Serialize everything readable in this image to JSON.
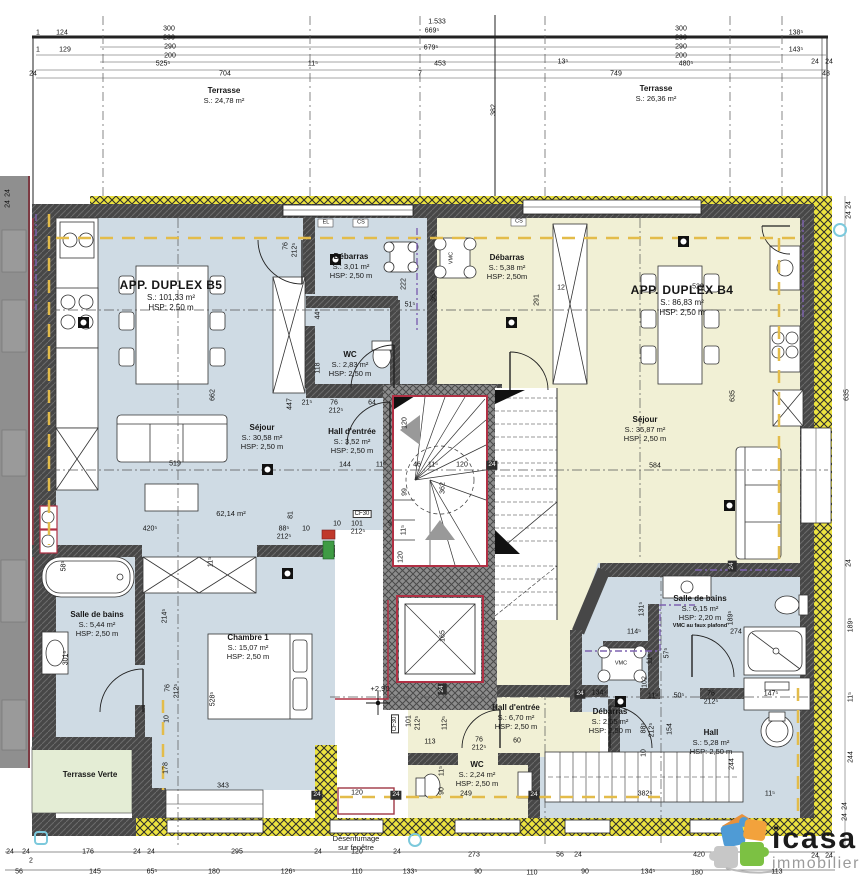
{
  "document": {
    "type": "Plan d'étage duplex",
    "level_marker": "+2,90"
  },
  "logo": {
    "brand": "icasa",
    "tagline": "immobilier"
  },
  "terraces": {
    "left": {
      "name": "Terrasse",
      "area": "S.: 24,78 m²"
    },
    "right": {
      "name": "Terrasse",
      "area": "S.: 26,36 m²"
    },
    "verte": {
      "name": "Terrasse Verte"
    }
  },
  "apartment_b5": {
    "title": "APP. DUPLEX B5",
    "area": "S.: 101,33 m²",
    "height": "HSP: 2,50 m",
    "rooms": {
      "debarras": {
        "name": "Débarras",
        "area": "S.: 3,01 m²",
        "height": "HSP: 2,50 m"
      },
      "wc": {
        "name": "WC",
        "area": "S.: 2,83 m²",
        "height": "HSP: 2,50 m"
      },
      "hall": {
        "name": "Hall d'entrée",
        "area": "S.: 3,52 m²",
        "height": "HSP: 2,50 m"
      },
      "sejour": {
        "name": "Séjour",
        "area": "S.: 30,58 m²",
        "height": "HSP: 2,50 m",
        "zone_area": "62,14 m²"
      },
      "salle_de_bains": {
        "name": "Salle de bains",
        "area": "S.: 5,44 m²",
        "height": "HSP: 2,50 m"
      },
      "chambre": {
        "name": "Chambre 1",
        "area": "S.: 15,07 m²",
        "height": "HSP: 2,50 m"
      }
    }
  },
  "apartment_b4": {
    "title": "APP. DUPLEX B4",
    "area": "S.: 86,83 m²",
    "height": "HSP: 2,50 m",
    "rooms": {
      "debarras": {
        "name": "Débarras",
        "area": "S.: 5,38 m²",
        "height": "HSP: 2,50m"
      },
      "sejour": {
        "name": "Séjour",
        "area": "S.: 35,87 m²",
        "height": "HSP: 2,50 m"
      },
      "hall_entree": {
        "name": "Hall d'entrée",
        "area": "S.: 6,70 m²",
        "height": "HSP: 2,50 m"
      },
      "wc": {
        "name": "WC",
        "area": "S.: 2,24 m²",
        "height": "HSP: 2,50 m"
      },
      "salle_de_bains": {
        "name": "Salle de bains",
        "area": "S.: 6,15 m²",
        "height": "HSP: 2,20 m",
        "note": "VMC au faux plafond"
      },
      "debarras2": {
        "name": "Débarras",
        "area": "S.: 2,65 m²",
        "height": "HSP: 2,50 m"
      },
      "hall": {
        "name": "Hall",
        "area": "S.: 5,28 m²",
        "height": "HSP: 2,50 m"
      }
    }
  },
  "annotations": {
    "desenfumage_1": "Désenfumage",
    "desenfumage_2": "sur fenêtre",
    "colors": {
      "b5_fill": "#cfdbe4",
      "b4_fill": "#f1f0d5",
      "green_fill": "#e4edd5",
      "wall": "#474747",
      "insulation": "#ece33f",
      "fire_wall": "#b03044",
      "gas_line": "#e3bc4a",
      "vmc_line": "#7e63b0",
      "marker_cyan": "#7cc9dc"
    },
    "dimensions": [
      {
        "t": "124",
        "x": 62,
        "y": 33
      },
      {
        "t": "1",
        "x": 38,
        "y": 33
      },
      {
        "t": "300",
        "x": 169,
        "y": 29
      },
      {
        "t": "230",
        "x": 169,
        "y": 38
      },
      {
        "t": "1",
        "x": 38,
        "y": 50
      },
      {
        "t": "129",
        "x": 65,
        "y": 50
      },
      {
        "t": "290",
        "x": 170,
        "y": 47
      },
      {
        "t": "200",
        "x": 170,
        "y": 56
      },
      {
        "t": "525⁵",
        "x": 163,
        "y": 64
      },
      {
        "t": "11⁵",
        "x": 313,
        "y": 64
      },
      {
        "t": "24",
        "x": 33,
        "y": 74
      },
      {
        "t": "704",
        "x": 225,
        "y": 74
      },
      {
        "t": "1.533",
        "x": 437,
        "y": 22
      },
      {
        "t": "669⁵",
        "x": 432,
        "y": 31
      },
      {
        "t": "679⁵",
        "x": 431,
        "y": 48
      },
      {
        "t": "453",
        "x": 440,
        "y": 64
      },
      {
        "t": "7",
        "x": 420,
        "y": 74
      },
      {
        "t": "382",
        "x": 494,
        "y": 110,
        "v": 1
      },
      {
        "t": "300",
        "x": 681,
        "y": 29
      },
      {
        "t": "230",
        "x": 681,
        "y": 38
      },
      {
        "t": "290",
        "x": 681,
        "y": 47
      },
      {
        "t": "200",
        "x": 681,
        "y": 56
      },
      {
        "t": "13⁵",
        "x": 563,
        "y": 62
      },
      {
        "t": "480⁵",
        "x": 686,
        "y": 64
      },
      {
        "t": "138⁵",
        "x": 796,
        "y": 33
      },
      {
        "t": "143⁵",
        "x": 796,
        "y": 50
      },
      {
        "t": "24",
        "x": 815,
        "y": 62
      },
      {
        "t": "24",
        "x": 829,
        "y": 62
      },
      {
        "t": "749",
        "x": 616,
        "y": 74
      },
      {
        "t": "48",
        "x": 826,
        "y": 74
      },
      {
        "t": "24",
        "x": 8,
        "y": 193,
        "v": 1
      },
      {
        "t": "24",
        "x": 8,
        "y": 204,
        "v": 1
      },
      {
        "t": "24",
        "x": 849,
        "y": 205,
        "v": 1
      },
      {
        "t": "24",
        "x": 849,
        "y": 215,
        "v": 1
      },
      {
        "t": "635",
        "x": 847,
        "y": 395,
        "v": 1
      },
      {
        "t": "24",
        "x": 849,
        "y": 563,
        "v": 1
      },
      {
        "t": "189⁵",
        "x": 851,
        "y": 625,
        "v": 1
      },
      {
        "t": "11⁵",
        "x": 851,
        "y": 697,
        "v": 1
      },
      {
        "t": "244",
        "x": 851,
        "y": 757,
        "v": 1
      },
      {
        "t": "24",
        "x": 845,
        "y": 806,
        "v": 1
      },
      {
        "t": "24",
        "x": 845,
        "y": 817,
        "v": 1
      },
      {
        "t": "76",
        "x": 286,
        "y": 246,
        "v": 1
      },
      {
        "t": "212⁵",
        "x": 295,
        "y": 250,
        "v": 1
      },
      {
        "t": "222",
        "x": 404,
        "y": 284,
        "v": 1
      },
      {
        "t": "51⁵",
        "x": 410,
        "y": 305
      },
      {
        "t": "44⁵",
        "x": 318,
        "y": 314,
        "v": 1
      },
      {
        "t": "118",
        "x": 318,
        "y": 368,
        "v": 1
      },
      {
        "t": "662",
        "x": 213,
        "y": 395,
        "v": 1
      },
      {
        "t": "447",
        "x": 290,
        "y": 404,
        "v": 1
      },
      {
        "t": "21⁵",
        "x": 307,
        "y": 403
      },
      {
        "t": "76",
        "x": 334,
        "y": 403
      },
      {
        "t": "212⁵",
        "x": 336,
        "y": 411
      },
      {
        "t": "64",
        "x": 372,
        "y": 403
      },
      {
        "t": "519",
        "x": 175,
        "y": 464
      },
      {
        "t": "420⁵",
        "x": 150,
        "y": 529
      },
      {
        "t": "88⁵",
        "x": 284,
        "y": 529
      },
      {
        "t": "212⁵",
        "x": 284,
        "y": 537
      },
      {
        "t": "10",
        "x": 306,
        "y": 529
      },
      {
        "t": "81",
        "x": 291,
        "y": 515,
        "v": 1
      },
      {
        "t": "58⁵",
        "x": 64,
        "y": 566,
        "v": 1
      },
      {
        "t": "11⁵",
        "x": 211,
        "y": 562,
        "v": 1
      },
      {
        "t": "214⁵",
        "x": 165,
        "y": 616,
        "v": 1
      },
      {
        "t": "301⁵",
        "x": 66,
        "y": 658,
        "v": 1
      },
      {
        "t": "528⁵",
        "x": 213,
        "y": 699,
        "v": 1
      },
      {
        "t": "76",
        "x": 168,
        "y": 688,
        "v": 1
      },
      {
        "t": "212⁵",
        "x": 177,
        "y": 691,
        "v": 1
      },
      {
        "t": "10",
        "x": 167,
        "y": 719,
        "v": 1
      },
      {
        "t": "178",
        "x": 166,
        "y": 768,
        "v": 1
      },
      {
        "t": "343",
        "x": 223,
        "y": 786
      },
      {
        "t": "24",
        "x": 317,
        "y": 795,
        "inv": 1
      },
      {
        "t": "120",
        "x": 357,
        "y": 793
      },
      {
        "t": "24",
        "x": 396,
        "y": 795,
        "inv": 1
      },
      {
        "t": "120",
        "x": 405,
        "y": 423,
        "v": 1
      },
      {
        "t": "144",
        "x": 345,
        "y": 465
      },
      {
        "t": "11⁵",
        "x": 381,
        "y": 465
      },
      {
        "t": "46",
        "x": 417,
        "y": 465
      },
      {
        "t": "11⁵",
        "x": 433,
        "y": 465
      },
      {
        "t": "120",
        "x": 462,
        "y": 465
      },
      {
        "t": "24",
        "x": 492,
        "y": 465,
        "inv": 1
      },
      {
        "t": "99",
        "x": 405,
        "y": 492,
        "v": 1
      },
      {
        "t": "362",
        "x": 443,
        "y": 488,
        "v": 1
      },
      {
        "t": "CF30",
        "x": 362,
        "y": 514,
        "box": 1
      },
      {
        "t": "10",
        "x": 337,
        "y": 524
      },
      {
        "t": "101",
        "x": 357,
        "y": 524
      },
      {
        "t": "212⁵",
        "x": 358,
        "y": 532
      },
      {
        "t": "9",
        "x": 390,
        "y": 524
      },
      {
        "t": "11⁵",
        "x": 404,
        "y": 530,
        "v": 1
      },
      {
        "t": "120",
        "x": 401,
        "y": 557,
        "v": 1
      },
      {
        "t": "165",
        "x": 443,
        "y": 636,
        "v": 1
      },
      {
        "t": "24",
        "x": 442,
        "y": 689,
        "v": 1,
        "inv": 1
      },
      {
        "t": "CF30",
        "x": 395,
        "y": 724,
        "v": 1,
        "box": 1
      },
      {
        "t": "101",
        "x": 409,
        "y": 721,
        "v": 1
      },
      {
        "t": "212⁵",
        "x": 418,
        "y": 723,
        "v": 1
      },
      {
        "t": "112⁵",
        "x": 445,
        "y": 723,
        "v": 1
      },
      {
        "t": "113",
        "x": 430,
        "y": 742
      },
      {
        "t": "76",
        "x": 479,
        "y": 740
      },
      {
        "t": "212⁵",
        "x": 479,
        "y": 748
      },
      {
        "t": "60",
        "x": 517,
        "y": 741
      },
      {
        "t": "11⁵",
        "x": 442,
        "y": 771,
        "v": 1
      },
      {
        "t": "90",
        "x": 442,
        "y": 791,
        "v": 1
      },
      {
        "t": "249",
        "x": 466,
        "y": 794
      },
      {
        "t": "24",
        "x": 534,
        "y": 795,
        "inv": 1
      },
      {
        "t": "12",
        "x": 561,
        "y": 288
      },
      {
        "t": "291",
        "x": 537,
        "y": 300,
        "v": 1
      },
      {
        "t": "363",
        "x": 434,
        "y": 296,
        "v": 1
      },
      {
        "t": "529",
        "x": 698,
        "y": 287
      },
      {
        "t": "635",
        "x": 733,
        "y": 396,
        "v": 1
      },
      {
        "t": "584",
        "x": 655,
        "y": 466
      },
      {
        "t": "24",
        "x": 580,
        "y": 694,
        "inv": 1
      },
      {
        "t": "134⁵",
        "x": 599,
        "y": 693
      },
      {
        "t": "131⁵",
        "x": 642,
        "y": 609,
        "v": 1
      },
      {
        "t": "114⁵",
        "x": 634,
        "y": 632
      },
      {
        "t": "57⁵",
        "x": 667,
        "y": 653,
        "v": 1
      },
      {
        "t": "11⁵",
        "x": 650,
        "y": 659,
        "v": 1
      },
      {
        "t": "102",
        "x": 645,
        "y": 682,
        "v": 1
      },
      {
        "t": "274",
        "x": 736,
        "y": 632
      },
      {
        "t": "189⁵",
        "x": 731,
        "y": 618,
        "v": 1
      },
      {
        "t": "24",
        "x": 732,
        "y": 566,
        "v": 1,
        "inv": 1
      },
      {
        "t": "11⁵",
        "x": 653,
        "y": 696
      },
      {
        "t": "50⁵",
        "x": 679,
        "y": 696
      },
      {
        "t": "76",
        "x": 711,
        "y": 694
      },
      {
        "t": "212⁵",
        "x": 711,
        "y": 702
      },
      {
        "t": "147⁵",
        "x": 771,
        "y": 694
      },
      {
        "t": "88⁵",
        "x": 644,
        "y": 728,
        "v": 1
      },
      {
        "t": "212⁵",
        "x": 652,
        "y": 730,
        "v": 1
      },
      {
        "t": "10",
        "x": 644,
        "y": 753,
        "v": 1
      },
      {
        "t": "154",
        "x": 670,
        "y": 729,
        "v": 1
      },
      {
        "t": "244",
        "x": 732,
        "y": 764,
        "v": 1
      },
      {
        "t": "382⁵",
        "x": 645,
        "y": 794
      },
      {
        "t": "11⁵",
        "x": 770,
        "y": 794
      },
      {
        "t": "EL",
        "x": 326,
        "y": 223,
        "s": 1
      },
      {
        "t": "CS",
        "x": 361,
        "y": 223,
        "s": 1
      },
      {
        "t": "CS",
        "x": 519,
        "y": 222,
        "s": 1
      },
      {
        "t": "VMC",
        "x": 452,
        "y": 258,
        "v": 1,
        "s": 1
      },
      {
        "t": "VMC",
        "x": 621,
        "y": 664,
        "s": 1
      },
      {
        "t": "24",
        "x": 10,
        "y": 852
      },
      {
        "t": "24",
        "x": 26,
        "y": 852
      },
      {
        "t": "2",
        "x": 31,
        "y": 861
      },
      {
        "t": "176",
        "x": 88,
        "y": 852
      },
      {
        "t": "24",
        "x": 137,
        "y": 852
      },
      {
        "t": "24",
        "x": 151,
        "y": 852
      },
      {
        "t": "295",
        "x": 237,
        "y": 852
      },
      {
        "t": "24",
        "x": 318,
        "y": 852
      },
      {
        "t": "120",
        "x": 357,
        "y": 852
      },
      {
        "t": "24",
        "x": 397,
        "y": 852
      },
      {
        "t": "273",
        "x": 474,
        "y": 855
      },
      {
        "t": "56",
        "x": 560,
        "y": 855
      },
      {
        "t": "24",
        "x": 578,
        "y": 855
      },
      {
        "t": "420",
        "x": 699,
        "y": 855
      },
      {
        "t": "24",
        "x": 815,
        "y": 856
      },
      {
        "t": "24",
        "x": 829,
        "y": 856
      },
      {
        "t": "56",
        "x": 19,
        "y": 872
      },
      {
        "t": "145",
        "x": 95,
        "y": 872
      },
      {
        "t": "65⁵",
        "x": 152,
        "y": 872
      },
      {
        "t": "180",
        "x": 214,
        "y": 872
      },
      {
        "t": "126⁵",
        "x": 288,
        "y": 872
      },
      {
        "t": "110",
        "x": 357,
        "y": 872
      },
      {
        "t": "133⁵",
        "x": 410,
        "y": 872
      },
      {
        "t": "90",
        "x": 478,
        "y": 872
      },
      {
        "t": "110",
        "x": 532,
        "y": 873
      },
      {
        "t": "90",
        "x": 585,
        "y": 872
      },
      {
        "t": "134⁵",
        "x": 648,
        "y": 872
      },
      {
        "t": "180",
        "x": 697,
        "y": 873
      },
      {
        "t": "113",
        "x": 777,
        "y": 872
      }
    ]
  }
}
